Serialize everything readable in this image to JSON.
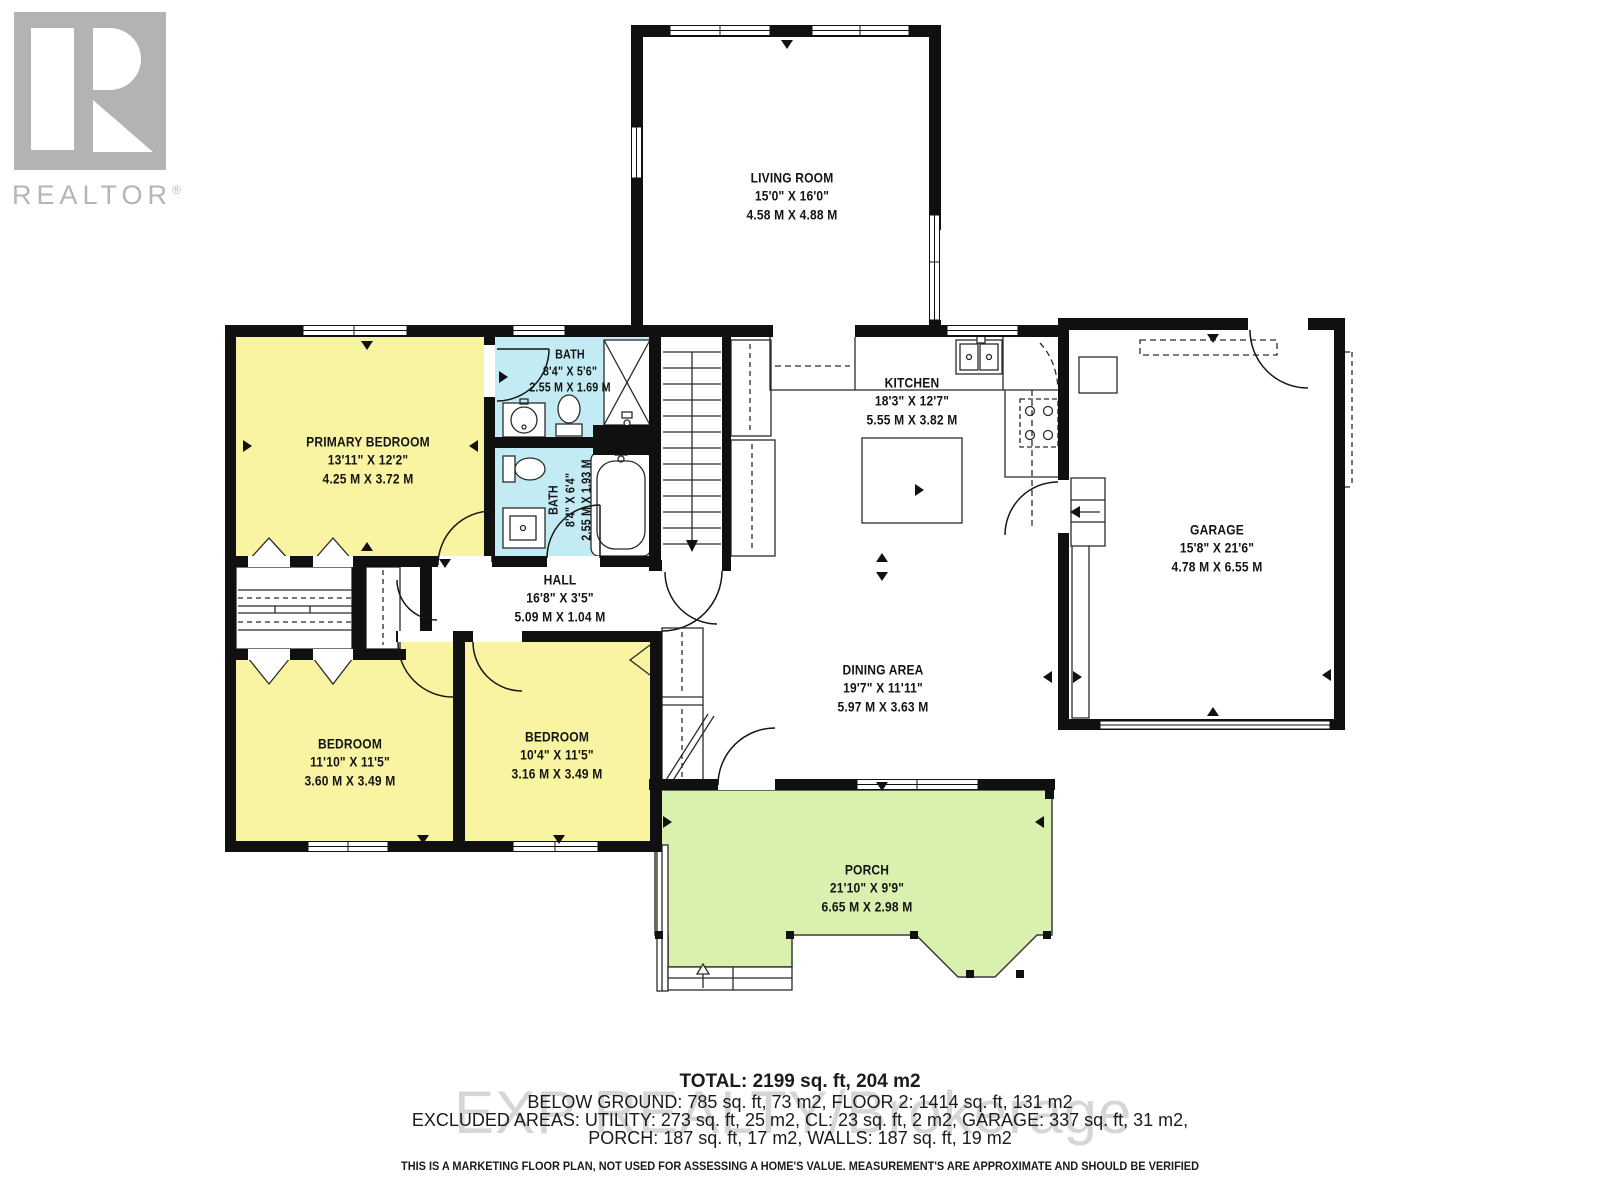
{
  "branding": {
    "logo_letter": "R",
    "logo_word": "REALTOR",
    "registered_mark": "®"
  },
  "rooms": [
    {
      "id": "living-room",
      "name": "LIVING ROOM",
      "imperial": "15'0\" X 16'0\"",
      "metric": "4.58 M X 4.88 M"
    },
    {
      "id": "primary-bedroom",
      "name": "PRIMARY BEDROOM",
      "imperial": "13'11\" X 12'2\"",
      "metric": "4.25 M X 3.72 M"
    },
    {
      "id": "bath-upper",
      "name": "BATH",
      "imperial": "8'4\" X 5'6\"",
      "metric": "2.55 M X 1.69 M"
    },
    {
      "id": "bath-lower",
      "name": "BATH",
      "imperial": "8'4\" X 6'4\"",
      "metric": "2.55 M X 1.93 M"
    },
    {
      "id": "kitchen",
      "name": "KITCHEN",
      "imperial": "18'3\" X 12'7\"",
      "metric": "5.55 M X 3.82 M"
    },
    {
      "id": "garage",
      "name": "GARAGE",
      "imperial": "15'8\" X 21'6\"",
      "metric": "4.78 M X 6.55 M"
    },
    {
      "id": "hall",
      "name": "HALL",
      "imperial": "16'8\" X 3'5\"",
      "metric": "5.09 M X 1.04 M"
    },
    {
      "id": "bedroom-left",
      "name": "BEDROOM",
      "imperial": "11'10\" X 11'5\"",
      "metric": "3.60 M X 3.49 M"
    },
    {
      "id": "bedroom-right",
      "name": "BEDROOM",
      "imperial": "10'4\" X 11'5\"",
      "metric": "3.16 M X 3.49 M"
    },
    {
      "id": "dining-area",
      "name": "DINING AREA",
      "imperial": "19'7\" X 11'11\"",
      "metric": "5.97 M X 3.63 M"
    },
    {
      "id": "porch",
      "name": "PORCH",
      "imperial": "21'10\" X 9'9\"",
      "metric": "6.65 M X 2.98 M"
    }
  ],
  "footer": {
    "total": "TOTAL: 2199 sq. ft, 204 m2",
    "line2": "BELOW GROUND: 785 sq. ft, 73 m2, FLOOR 2: 1414 sq. ft, 131 m2",
    "line3": "EXCLUDED AREAS: UTILITY: 273 sq. ft, 25 m2, CL: 23 sq. ft, 2 m2, GARAGE: 337 sq. ft, 31 m2,",
    "line4": "PORCH: 187 sq. ft, 17 m2, WALLS: 187 sq. ft, 19 m2",
    "disclaimer": "THIS IS A MARKETING FLOOR PLAN, NOT USED FOR ASSESSING A HOME'S VALUE. MEASUREMENT'S ARE APPROXIMATE AND SHOULD BE VERIFIED"
  },
  "watermark": "EXP REALTY/Brokerage",
  "icons": [
    "stairs-icon",
    "toilet-icon",
    "sink-icon",
    "bathtub-icon",
    "shower-icon",
    "stove-icon",
    "kitchen-sink-icon",
    "island-icon",
    "bifold-door-icon",
    "door-swing-icon",
    "window-icon",
    "realtor-logo-icon"
  ],
  "colors": {
    "bedroom": "#F8F4A2",
    "bath": "#C3EBF4",
    "porch": "#D9F0AF",
    "wall": "#101010",
    "line": "#2b2b2b",
    "logo": "#b3b3b3",
    "watermark": "#d6d6d6"
  }
}
